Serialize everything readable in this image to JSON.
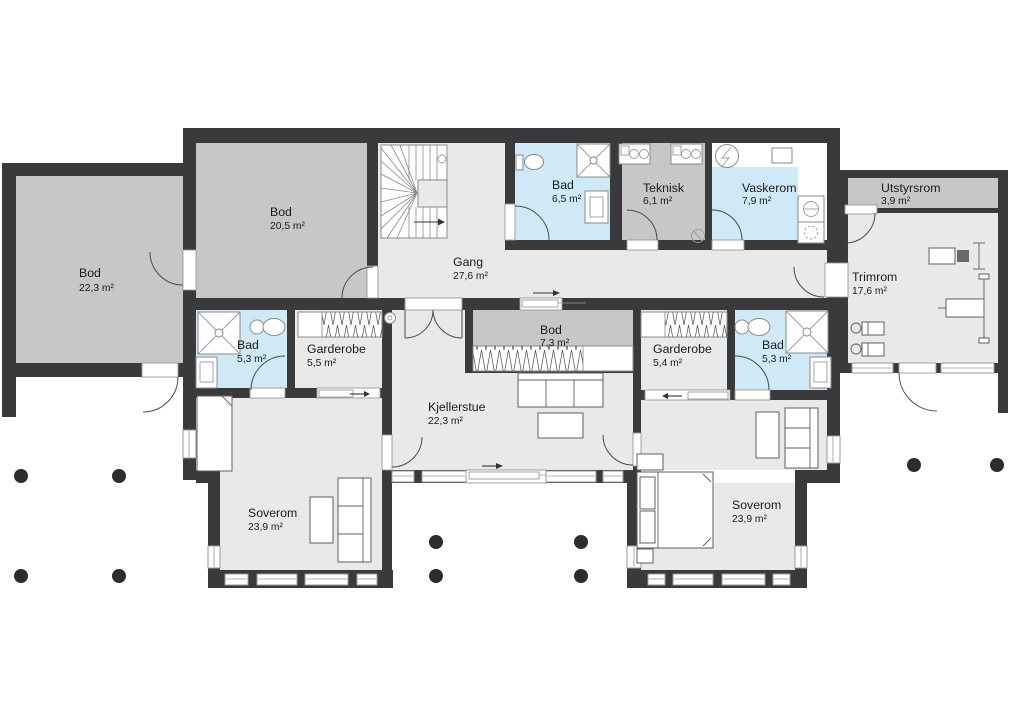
{
  "rooms": {
    "bod_annex": {
      "name": "Bod",
      "area": "22,3 m²"
    },
    "bod_main": {
      "name": "Bod",
      "area": "20,5 m²"
    },
    "gang": {
      "name": "Gang",
      "area": "27,6 m²"
    },
    "bad_65": {
      "name": "Bad",
      "area": "6,5 m²"
    },
    "teknisk": {
      "name": "Teknisk",
      "area": "6,1 m²"
    },
    "vaskerom": {
      "name": "Vaskerom",
      "area": "7,9 m²"
    },
    "utstyrsrom": {
      "name": "Utstyrsrom",
      "area": "3,9 m²"
    },
    "trimrom": {
      "name": "Trimrom",
      "area": "17,6 m²"
    },
    "bad_left": {
      "name": "Bad",
      "area": "5,3 m²"
    },
    "garderobe_left": {
      "name": "Garderobe",
      "area": "5,5 m²"
    },
    "bod_center": {
      "name": "Bod",
      "area": "7,3 m²"
    },
    "garderobe_right": {
      "name": "Garderobe",
      "area": "5,4 m²"
    },
    "bad_right": {
      "name": "Bad",
      "area": "5,3 m²"
    },
    "kjellerstue": {
      "name": "Kjellerstue",
      "area": "22,3 m²"
    },
    "soverom_left": {
      "name": "Soverom",
      "area": "23,9 m²"
    },
    "soverom_right": {
      "name": "Soverom",
      "area": "23,9 m²"
    }
  },
  "colors": {
    "wall": "#3a3a3c",
    "floor": "#e8e9eb",
    "storage_floor": "#c6c7c9",
    "wet_floor": "#cfe9f6",
    "white": "#ffffff"
  }
}
